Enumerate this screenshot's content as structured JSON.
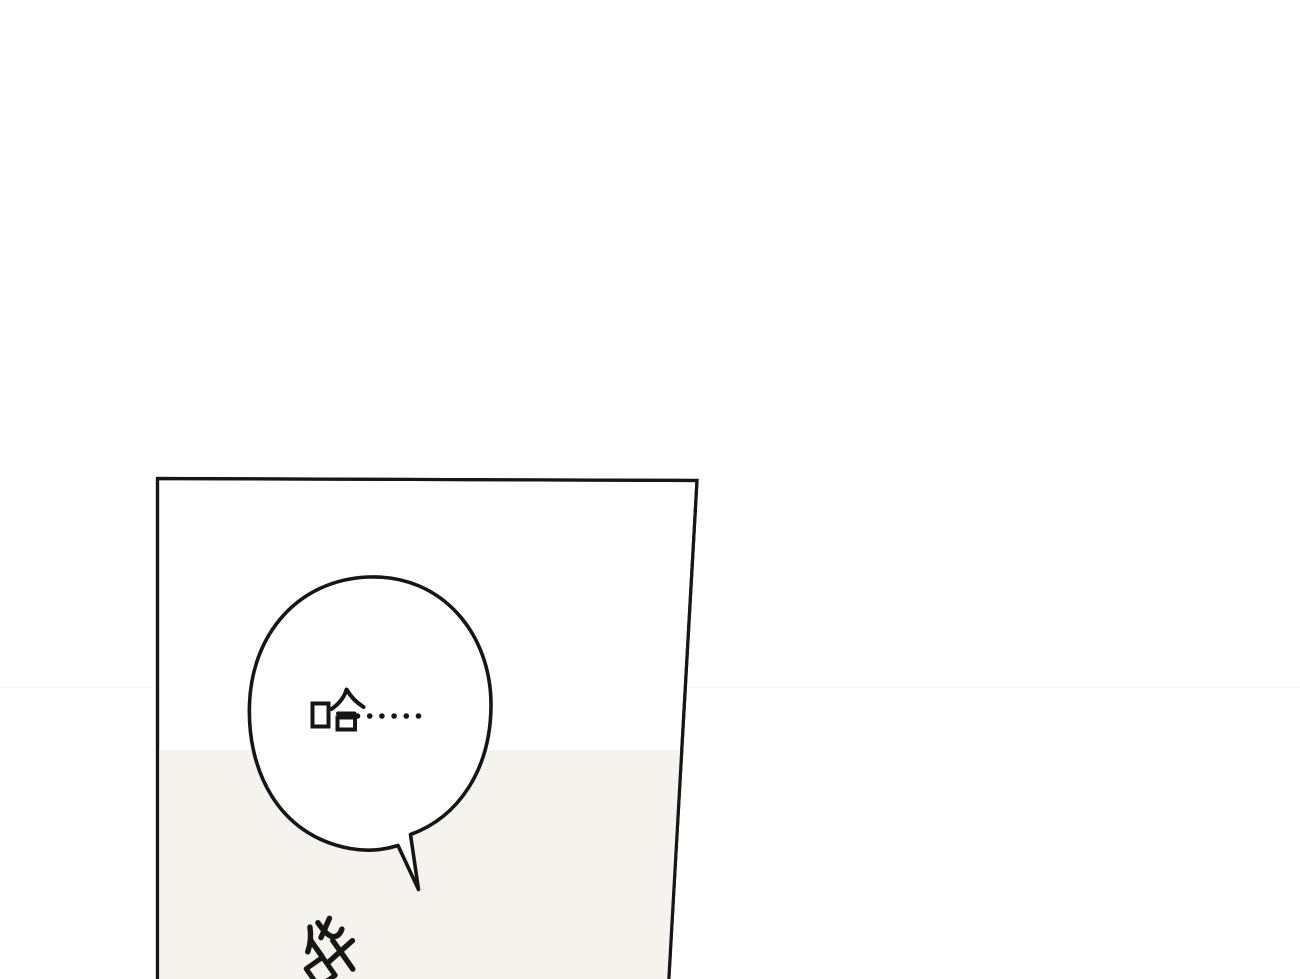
{
  "page": {
    "background_color": "#ffffff"
  },
  "panel": {
    "border_color": "#161616",
    "wall_color": "#ffffff",
    "floor_color": "#f4f3ee",
    "speech_bubble": {
      "text": "哈……",
      "fill_color": "#ffffff",
      "stroke_color": "#161616",
      "text_color": "#161616"
    },
    "sfx": {
      "text": "哗",
      "color": "#161616",
      "rotation_deg": -35
    }
  }
}
